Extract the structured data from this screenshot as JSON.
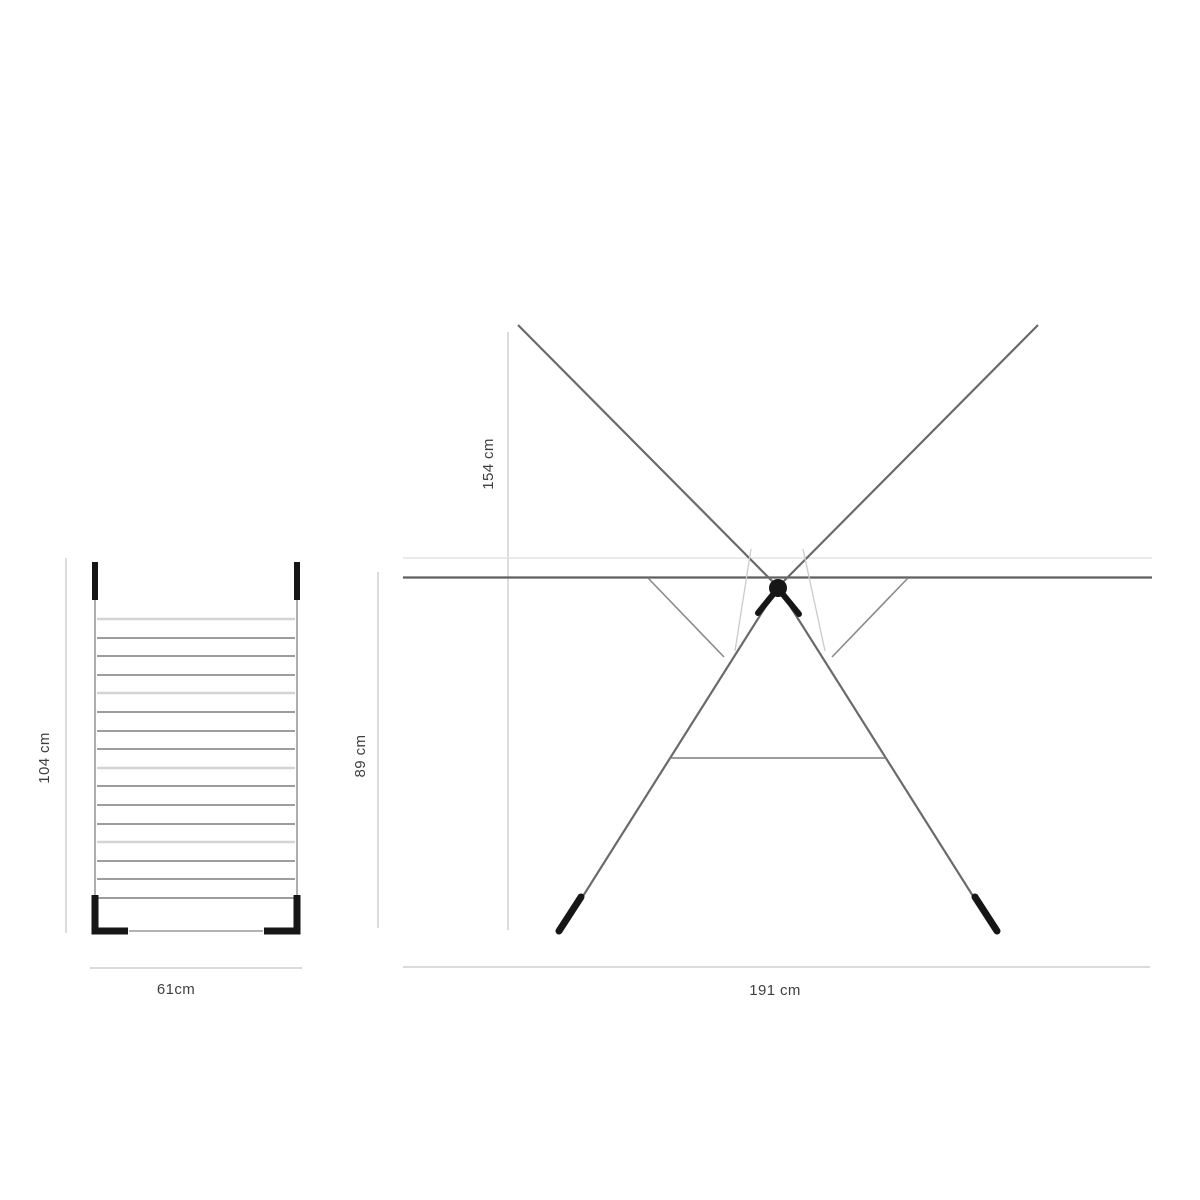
{
  "page": {
    "background": "#ffffff",
    "subject": "Clothes drying rack technical dimension drawing"
  },
  "diagram": {
    "views": [
      {
        "id": "top_view",
        "description": "Top / folded view of drying rack with parallel drying bars",
        "bar_count": 16,
        "labels": {
          "height": "104 cm",
          "width": "61cm"
        }
      },
      {
        "id": "front_view",
        "description": "Open front view with crossed arms, legs and hub",
        "labels": {
          "total_height": "154 cm",
          "frame_height": "89 cm",
          "width": "191 cm"
        }
      }
    ],
    "colors": {
      "frame_line": "#6a6a6a",
      "top_bar": "#5f5f5f",
      "dark_bar": "#8f8f8f",
      "light_bar": "#d4d4d4",
      "wire": "#cbcbcb",
      "dimension_line": "#dcdcdc",
      "black_parts": "#161616",
      "label_text": "#3f3f3f"
    }
  }
}
